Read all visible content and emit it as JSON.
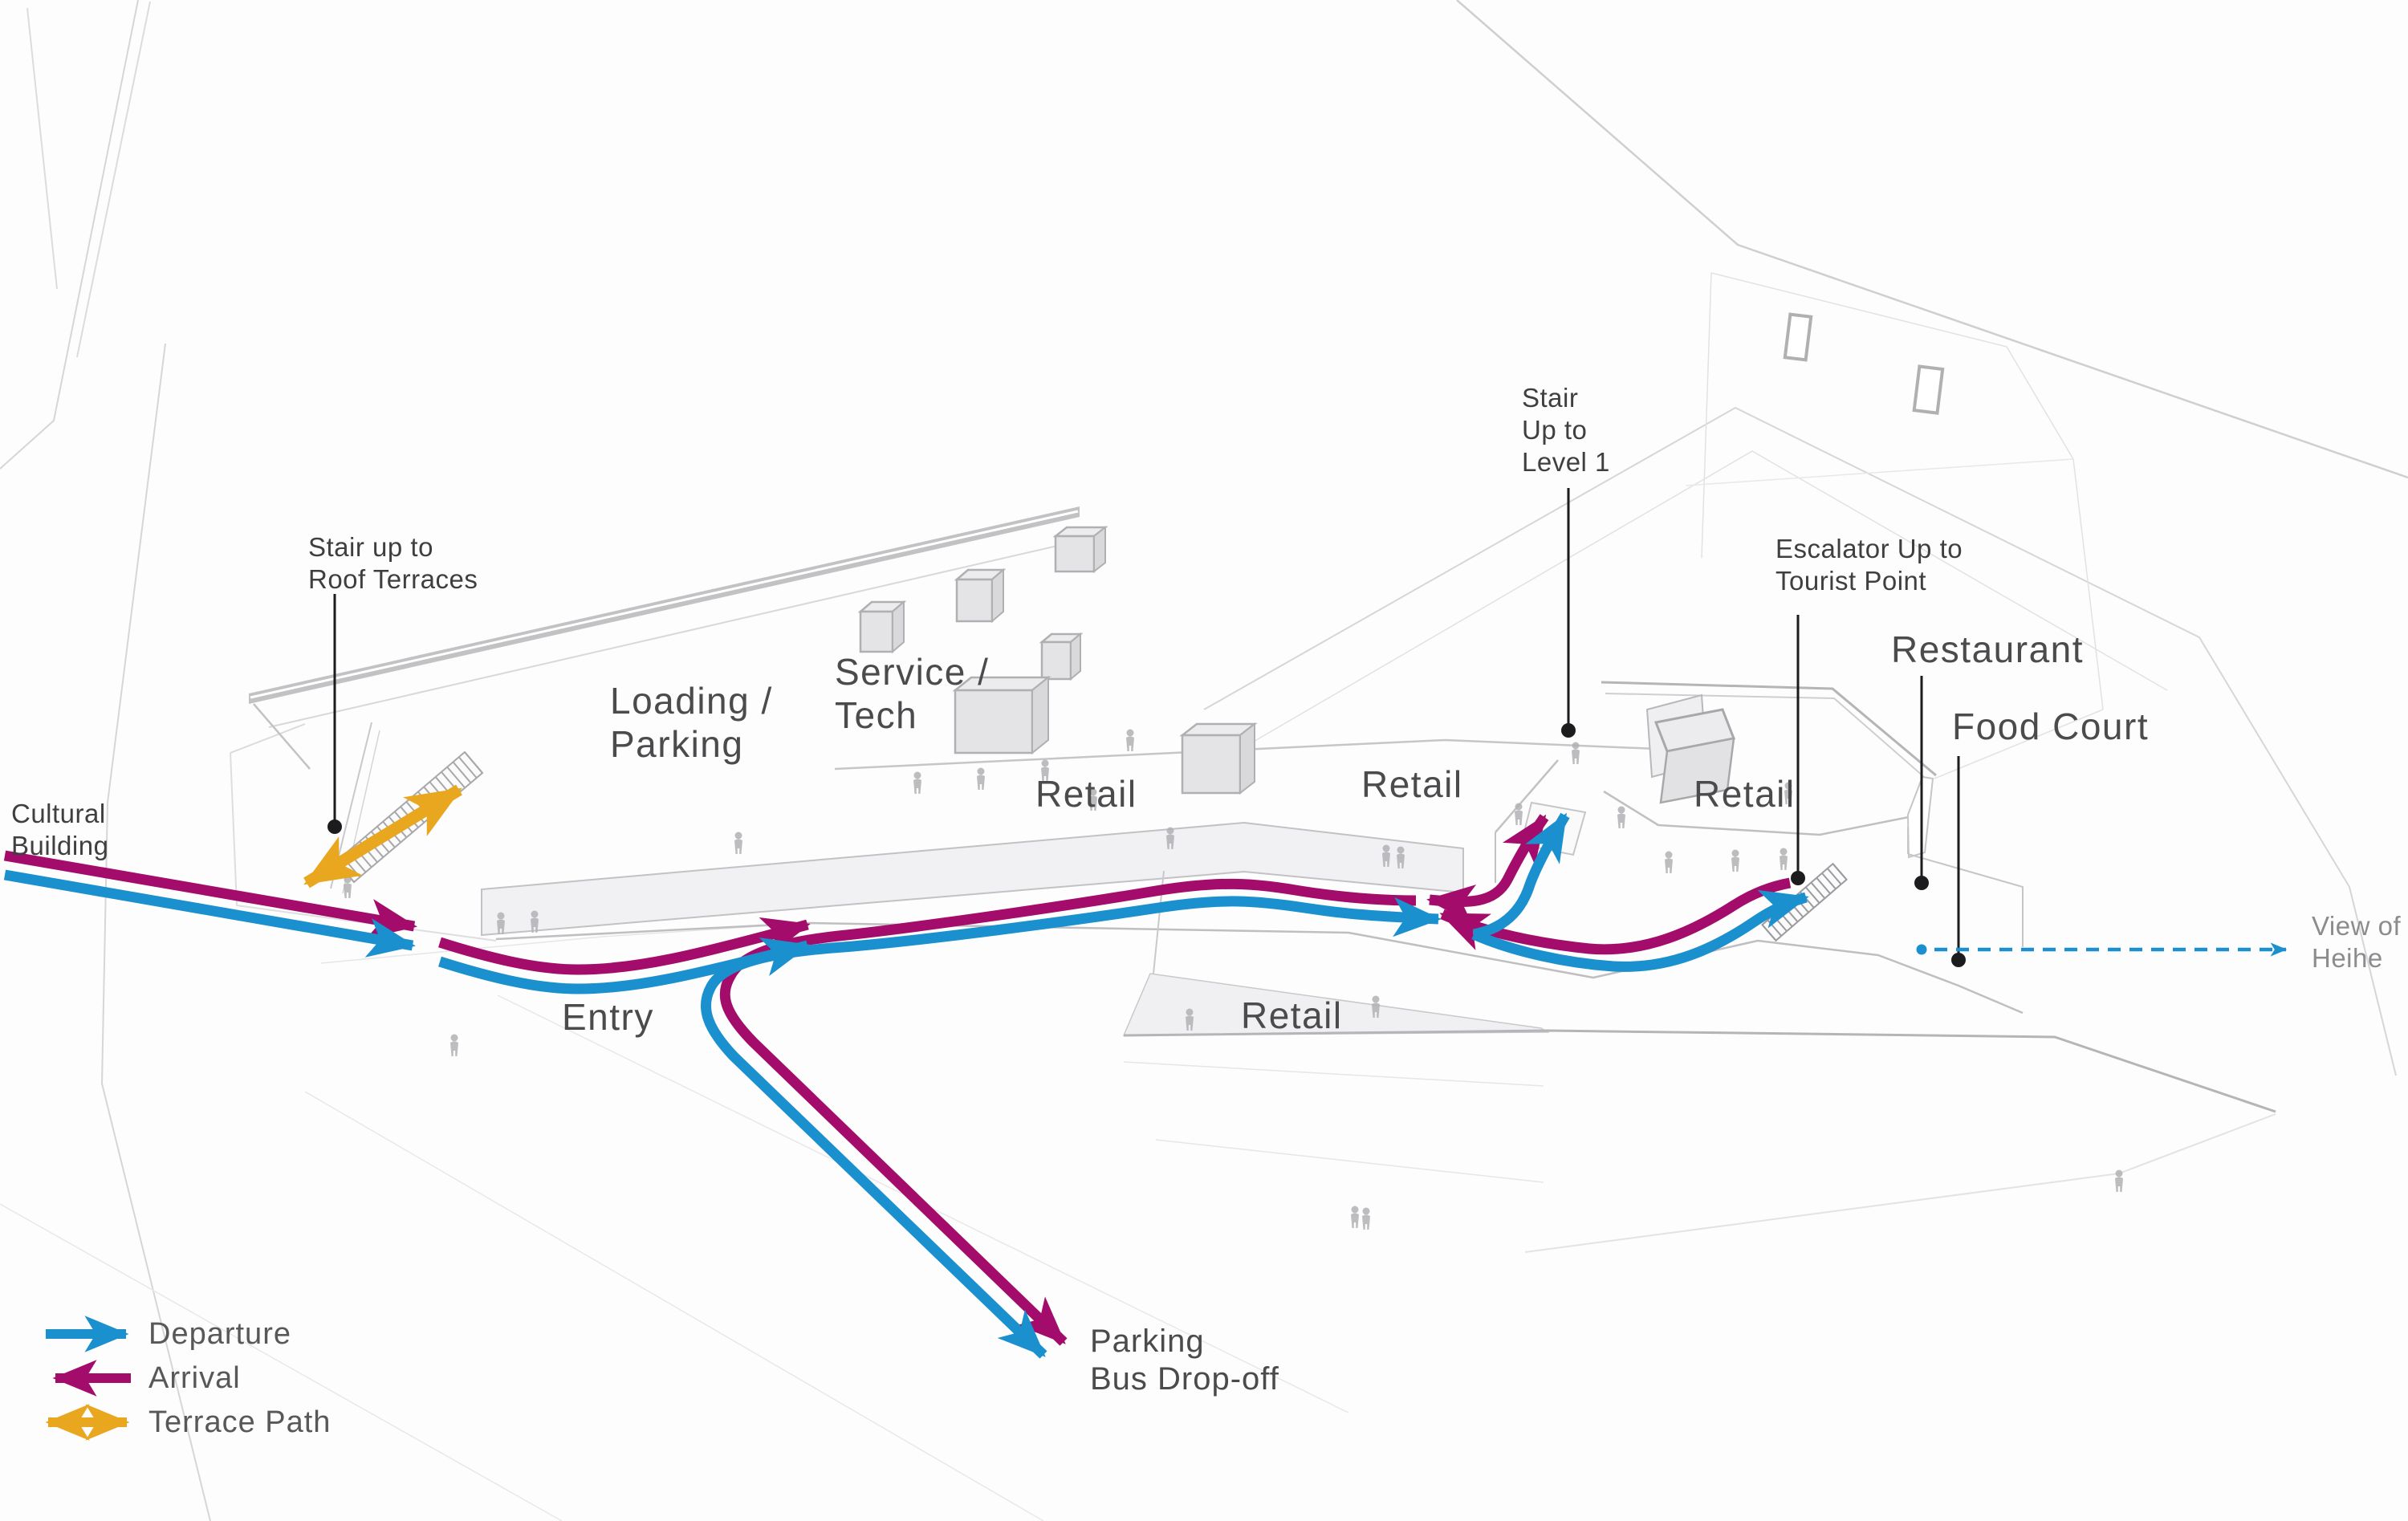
{
  "diagram_type": "building-circulation-site-plan",
  "colors": {
    "departure": "#1b90ce",
    "arrival": "#a30c6b",
    "terrace": "#e9a71f",
    "leader": "#1c1c1e",
    "label": "#4b4b4d",
    "annotation": "#3f3f41",
    "muted": "#8c8c8f"
  },
  "legend": {
    "items": [
      {
        "label": "Departure",
        "color_key": "departure",
        "direction": "right"
      },
      {
        "label": "Arrival",
        "color_key": "arrival",
        "direction": "left"
      },
      {
        "label": "Terrace Path",
        "color_key": "terrace",
        "direction": "both"
      }
    ]
  },
  "zones": {
    "loading_parking": [
      "Loading /",
      "Parking"
    ],
    "service_tech": [
      "Service /",
      "Tech"
    ],
    "retail": "Retail",
    "entry": "Entry",
    "restaurant": "Restaurant",
    "food_court": "Food Court"
  },
  "annotations": {
    "cultural_building": [
      "Cultural",
      "Building"
    ],
    "stair_roof": [
      "Stair up to",
      "Roof Terraces"
    ],
    "stair_level1": [
      "Stair",
      "Up to",
      "Level 1"
    ],
    "escalator": [
      "Escalator Up to",
      "Tourist Point"
    ],
    "view": [
      "View of",
      "Heihe"
    ],
    "parking": [
      "Parking",
      "Bus Drop-off"
    ]
  }
}
